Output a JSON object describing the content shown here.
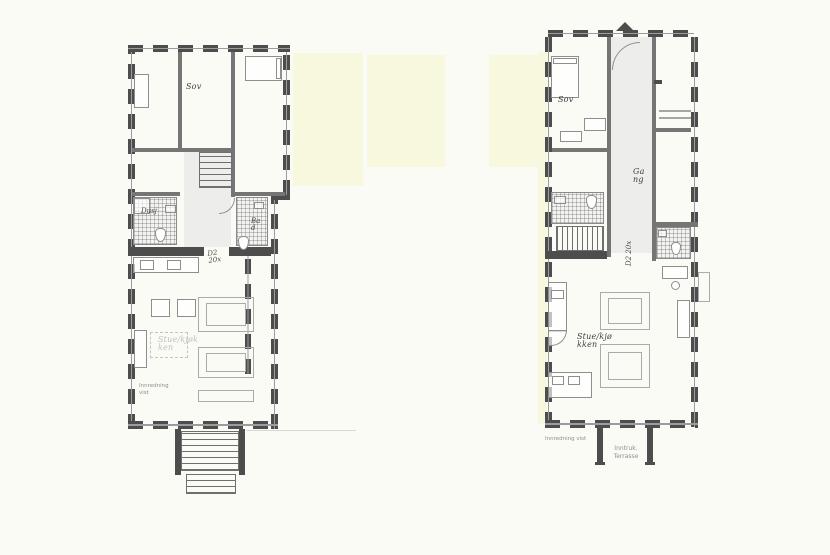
{
  "drawing": {
    "type": "floor-plan",
    "background": "#fbfbf5",
    "colors": {
      "wall": "#4d4d4d",
      "cream_block": "#f8f8df",
      "hall_fill": "#ededeb"
    }
  },
  "left_unit": {
    "bedroom_label": "Sov",
    "shower_label": "Dusj",
    "bath_label": "Bad",
    "living_label": "Stue/kjøkken",
    "door_label_line1": "D2",
    "door_label_line2": "20x",
    "note": "Innredning vist"
  },
  "right_unit": {
    "bedroom_label": "Sov",
    "hall_label": "Gang",
    "living_label": "Stue/kjøkken",
    "door_label": "D2 20x",
    "terrace_label_1": "Inntruk.",
    "terrace_label_2": "Terrasse",
    "note": "Innredning vist"
  }
}
